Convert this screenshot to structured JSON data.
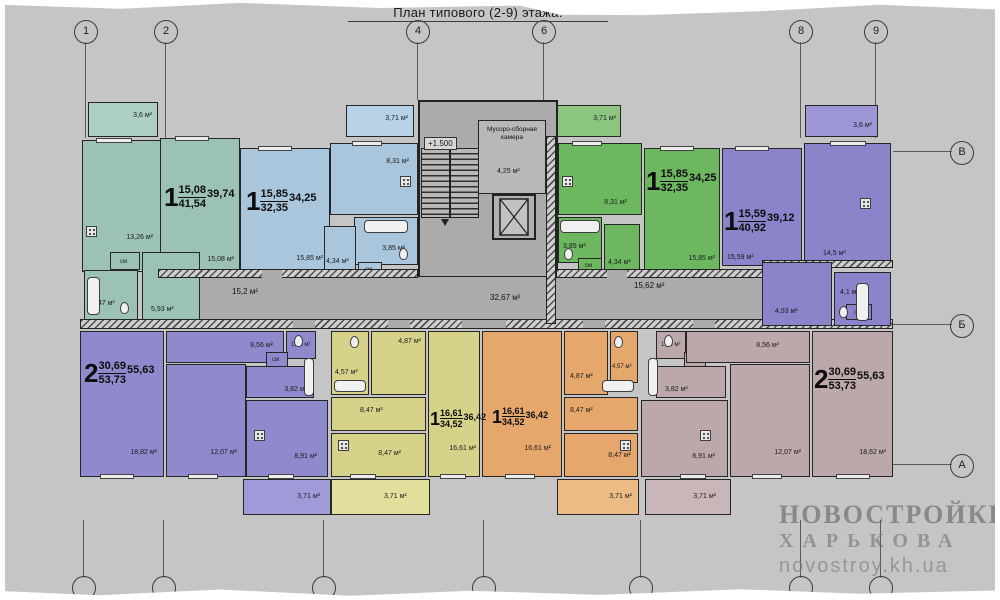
{
  "title": "План типового (2-9) этажа.",
  "axes": {
    "top": [
      "1",
      "2",
      "4",
      "6",
      "8",
      "9"
    ],
    "right": [
      "В",
      "Б",
      "А"
    ]
  },
  "core": {
    "elevation_mark": "+1.500",
    "garbage_room_name": "Мусоро-сборная камера",
    "garbage_room_area": "4,25 м²",
    "corridor_left_area": "15,2 м²",
    "corridor_center_area": "32,67 м²",
    "corridor_right_area": "15,62 м²"
  },
  "apartments": {
    "teal": {
      "rooms_count": "1",
      "living_area": "15,08",
      "total_area": "41,54",
      "reduced_area": "39,74",
      "balcony": "3,6 м²",
      "kitchen": "13,26 м²",
      "living_room": "15,08 м²",
      "bathroom": "5,47 м²",
      "hallway": "5,93 м²",
      "closet": "см"
    },
    "blue": {
      "rooms_count": "1",
      "living_area": "15,85",
      "total_area": "32,35",
      "reduced_area": "34,25",
      "balcony": "3,71 м²",
      "kitchen": "8,31 м²",
      "living_room": "15,85 м²",
      "hallway": "4,34 м²",
      "bathroom": "3,85 м²",
      "closet": "см"
    },
    "green": {
      "rooms_count": "1",
      "living_area": "15,85",
      "total_area": "32,35",
      "reduced_area": "34,25",
      "balcony": "3,71 м²",
      "kitchen": "8,31 м²",
      "living_room": "15,85 м²",
      "hallway": "4,34 м²",
      "bathroom": "3,85 м²",
      "closet": "см"
    },
    "purple": {
      "rooms_count": "1",
      "living_area": "15,59",
      "total_area": "40,92",
      "reduced_area": "39,12",
      "balcony": "3,6 м²",
      "kitchen": "14,5 м²",
      "living_room": "15,59 м²",
      "bathroom": "4,1 м²",
      "hallway": "4,93 м²",
      "closet": "см"
    },
    "violet2": {
      "rooms_count": "2",
      "living_area": "30,69",
      "total_area": "53,73",
      "reduced_area": "55,63",
      "room1": "18,82 м²",
      "room2": "12,07 м²",
      "kitchen": "8,91 м²",
      "kitchen_top": "8,56 м²",
      "wc": "1,75 м²",
      "hallway": "3,82 м²",
      "balcony": "3,71 м²",
      "closet": "см"
    },
    "yellow": {
      "rooms_count": "1",
      "living_area": "16,61",
      "total_area": "34,52",
      "reduced_area": "36,42",
      "living_room": "16,61 м²",
      "bathroom": "4,57 м²",
      "hall_top": "4,87 м²",
      "hallway": "8,47 м²",
      "kitchen": "8,47 м²",
      "balcony": "3,71 м²"
    },
    "orange": {
      "rooms_count": "1",
      "living_area": "16,61",
      "total_area": "34,52",
      "reduced_area": "36,42",
      "living_room": "16,61 м²",
      "bathroom": "4,57 м²",
      "hall_top": "4,87 м²",
      "hallway": "8,47 м²",
      "kitchen": "8,47 м²",
      "balcony": "3,71 м²"
    },
    "mauve2": {
      "rooms_count": "2",
      "living_area": "30,69",
      "total_area": "53,73",
      "reduced_area": "55,63",
      "room1": "18,62 м²",
      "room2": "12,07 м²",
      "kitchen": "8,91 м²",
      "kitchen_top": "8,56 м²",
      "wc": "1,75 м²",
      "hallway": "3,82 м²",
      "balcony": "3,71 м²",
      "closet": "см"
    }
  },
  "watermark": {
    "line1": "НОВОСТРОЙКИ",
    "line2": "ХАРЬКОВА",
    "line3": "novostroy.kh.ua"
  },
  "colors": {
    "teal": "#9cc2b4",
    "blue": "#a9c6dd",
    "green": "#6db760",
    "purple": "#8a84cb",
    "violet": "#8f8acd",
    "yellow": "#d6d289",
    "orange": "#e6a76c",
    "mauve": "#bca8aa",
    "corridor": "#ababab",
    "paper": "#c5c5c5"
  }
}
